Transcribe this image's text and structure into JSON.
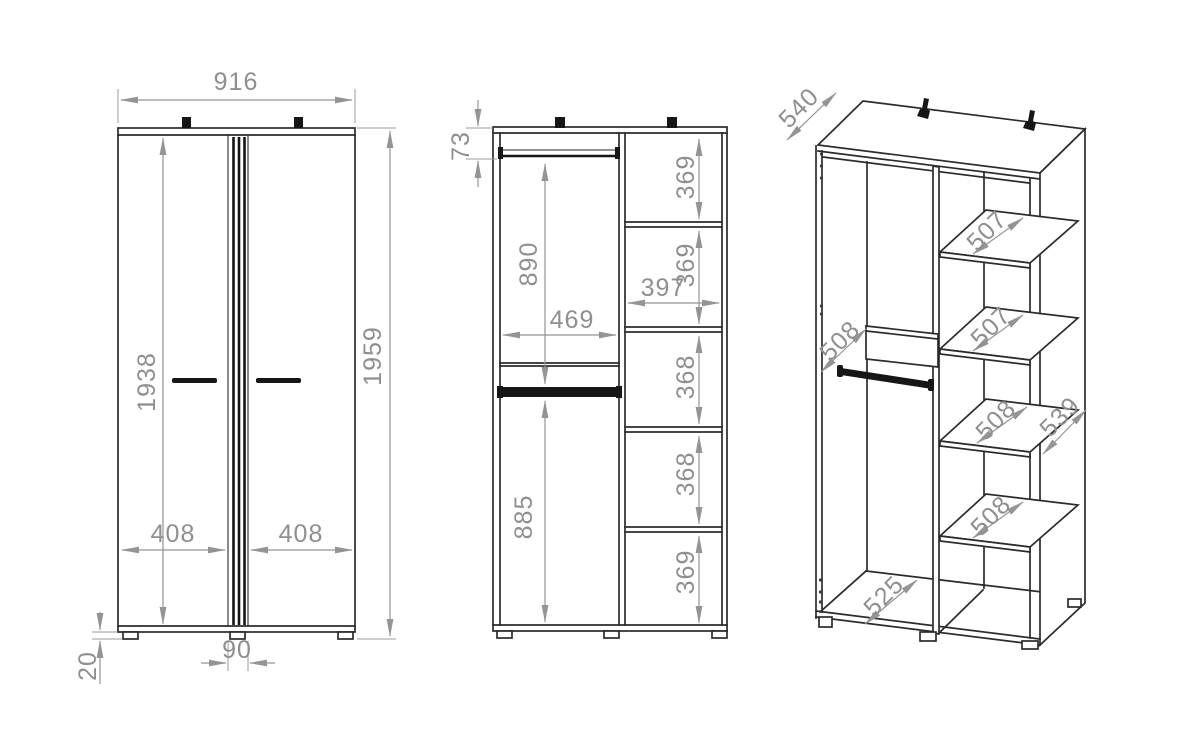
{
  "drawing": {
    "type": "wardrobe-technical-drawing",
    "units": "mm",
    "front_view": {
      "width": "916",
      "height_total": "1959",
      "height_interior": "1938",
      "door_left_width": "408",
      "door_right_width": "408",
      "center_gap": "90",
      "foot_height": "20"
    },
    "interior_view": {
      "rail_top_offset": "73",
      "upper_hanging_height": "890",
      "left_section_width": "469",
      "lower_hanging_height": "885",
      "right_section_width": "397",
      "shelf_gaps": [
        "369",
        "369",
        "368",
        "368",
        "369"
      ]
    },
    "iso_view": {
      "top_depth": "540",
      "rail_depth": "508",
      "shelf_depths": [
        "507",
        "507",
        "508",
        "508"
      ],
      "side_depth": "539",
      "floor_depth": "525"
    }
  }
}
